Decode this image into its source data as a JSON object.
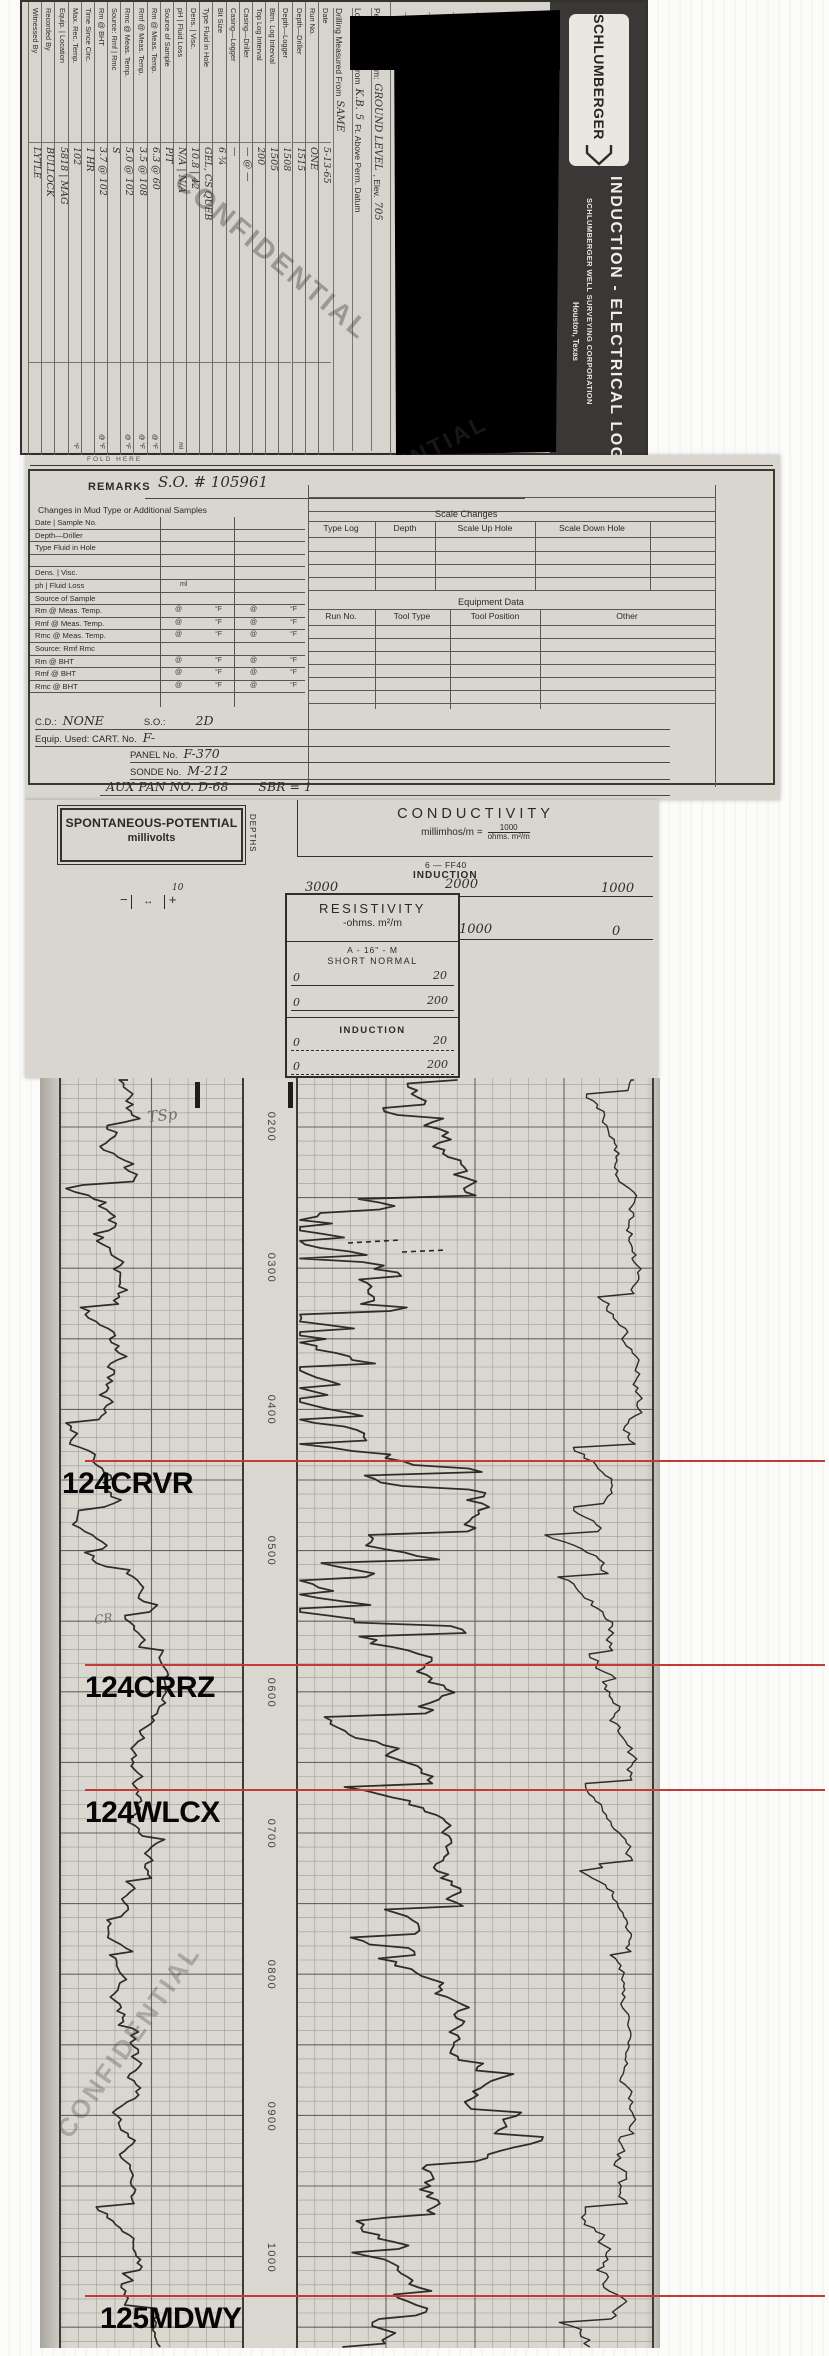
{
  "banner": {
    "logo": "SCHLUMBERGER",
    "title": "INDUCTION - ELECTRICAL LOG",
    "subtitle": "SCHLUMBERGER WELL SURVEYING CORPORATION",
    "city": "Houston, Texas"
  },
  "stamps": {
    "confidential": "CONFIDENTIAL",
    "fold": "FOLD HERE"
  },
  "datum": {
    "l1a": "Permanent Datum:",
    "l1v": "GROUND LEVEL",
    "l1b": ", Elev.",
    "l1v2": "705",
    "l2a": "Log Measured From",
    "l2v": "K.B.",
    "l2v2": "5",
    "l2b": "Ft. Above Perm. Datum",
    "l3a": "Drilling Measured From",
    "l3v": "SAME"
  },
  "run_table": {
    "rows": [
      {
        "label": "Date",
        "value": "5-13-65",
        "unit": ""
      },
      {
        "label": "Run No.",
        "value": "ONE",
        "unit": ""
      },
      {
        "label": "Depth—Driller",
        "value": "1515",
        "unit": ""
      },
      {
        "label": "Depth—Logger",
        "value": "1508",
        "unit": ""
      },
      {
        "label": "Btm. Log Interval",
        "value": "1505",
        "unit": ""
      },
      {
        "label": "Top Log Interval",
        "value": "200",
        "unit": ""
      },
      {
        "label": "Casing—Driller",
        "value": "— @ —",
        "unit": ""
      },
      {
        "label": "Casing—Logger",
        "value": "—",
        "unit": ""
      },
      {
        "label": "Bit Size",
        "value": "6 ¾",
        "unit": ""
      },
      {
        "label": "Type Fluid in Hole",
        "value": "GEL, CS   QUEB",
        "unit": ""
      },
      {
        "label": "Dens.  |  Visc.",
        "value": "10.8  |  42",
        "unit": ""
      },
      {
        "label": "pH  |  Fluid Loss",
        "value": "N/A  |  N/A",
        "unit": "ml"
      },
      {
        "label": "Source of Sample",
        "value": "PIT",
        "unit": ""
      },
      {
        "label": "Rm @ Meas. Temp.",
        "value": "6.3 @ 60",
        "unit": "@      °F"
      },
      {
        "label": "Rmf @ Meas. Temp.",
        "value": "3.5 @ 108",
        "unit": "@      °F"
      },
      {
        "label": "Rmc @ Meas. Temp.",
        "value": "5.0 @ 102",
        "unit": "@      °F"
      },
      {
        "label": "Source: Rmf  |  Rmc",
        "value": "S",
        "unit": ""
      },
      {
        "label": "Rm @ BHT",
        "value": "3.7 @ 102",
        "unit": "@      °F"
      },
      {
        "label": "Time Since Circ.",
        "value": "1 HR",
        "unit": ""
      },
      {
        "label": "Max. Rec. Temp.",
        "value": "102",
        "unit": "°F"
      },
      {
        "label": "Equip.  |  Location",
        "value": "5818  |  MAG",
        "unit": ""
      },
      {
        "label": "Recorded By",
        "value": "BULLOCK",
        "unit": ""
      },
      {
        "label": "Witnessed By",
        "value": "LYTLE",
        "unit": ""
      }
    ]
  },
  "remarks": {
    "label": "REMARKS",
    "value": "S.O. # 105961",
    "changes_title": "Changes in Mud Type or Additional Samples",
    "rows": [
      {
        "text": "Date  |  Sample No.",
        "temp": false,
        "unit": ""
      },
      {
        "text": "Depth—Driller",
        "temp": false,
        "unit": ""
      },
      {
        "text": "Type Fluid in Hole",
        "temp": false,
        "unit": ""
      },
      {
        "text": "",
        "temp": false,
        "unit": ""
      },
      {
        "text": "Dens.  |  Visc.",
        "temp": false,
        "unit": ""
      },
      {
        "text": "ph  |  Fluid Loss",
        "temp": false,
        "unit": "ml"
      },
      {
        "text": "Source of Sample",
        "temp": false,
        "unit": ""
      },
      {
        "text": "Rm @ Meas. Temp.",
        "temp": true,
        "unit": ""
      },
      {
        "text": "Rmf @ Meas. Temp.",
        "temp": true,
        "unit": ""
      },
      {
        "text": "Rmc @ Meas. Temp.",
        "temp": true,
        "unit": ""
      },
      {
        "text": "Source: Rmf      Rmc",
        "temp": false,
        "unit": ""
      },
      {
        "text": "Rm @ BHT",
        "temp": true,
        "unit": ""
      },
      {
        "text": "Rmf @ BHT",
        "temp": true,
        "unit": ""
      },
      {
        "text": "Rmc @ BHT",
        "temp": true,
        "unit": ""
      }
    ],
    "scale_changes": {
      "title": "Scale Changes",
      "columns": [
        "Type Log",
        "Depth",
        "Scale Up Hole",
        "Scale Down Hole"
      ]
    },
    "equipment": {
      "title": "Equipment Data",
      "columns": [
        "Run No.",
        "Tool Type",
        "Tool Position",
        "Other"
      ]
    },
    "footer": [
      {
        "pre": "C.D.:",
        "hw": "NONE",
        "pre2": "S.O.:",
        "hw2": "2D",
        "indent": 5
      },
      {
        "pre": "Equip. Used:  CART. No.",
        "hw": "F-",
        "pre2": "",
        "hw2": "",
        "indent": 5
      },
      {
        "pre": "PANEL No.",
        "hw": "F-370",
        "pre2": "",
        "hw2": "",
        "indent": 100
      },
      {
        "pre": "SONDE No.",
        "hw": "M-212",
        "pre2": "",
        "hw2": "",
        "indent": 100
      },
      {
        "pre": "",
        "hw": "AUX PAN NO. D-68",
        "pre2": "",
        "hw2": "SBR = 1",
        "indent": 70
      }
    ]
  },
  "scale_header": {
    "sp_title": "SPONTANEOUS-POTENTIAL",
    "sp_units": "millivolts",
    "sp_minus": "−",
    "sp_scale": "10",
    "sp_plus": "+",
    "depths": "DEPTHS",
    "cond_title": "CONDUCTIVITY",
    "cond_units": "millimhos/m =",
    "cond_frac_top": "1000",
    "cond_frac_bot": "ohms. m²/m",
    "tool_line": "6 — FF40",
    "tool_line2": "INDUCTION",
    "cond_scale1": {
      "left": "3000",
      "mid": "2000",
      "right": "1000"
    },
    "cond_scale2": {
      "mid": "1000",
      "right": "0"
    },
    "res_title": "RESISTIVITY",
    "res_units": "-ohms. m²/m",
    "sn1": "A - 16\" - M",
    "sn2": "SHORT NORMAL",
    "sn_scales": [
      {
        "l": "0",
        "r": "20"
      },
      {
        "l": "0",
        "r": "200"
      }
    ],
    "ind_label": "INDUCTION",
    "ind_scales": [
      {
        "l": "0",
        "r": "20"
      },
      {
        "l": "0",
        "r": "200"
      }
    ]
  },
  "log": {
    "depth_labels": [
      {
        "t": "0200",
        "y": 1127
      },
      {
        "t": "0300",
        "y": 1268
      },
      {
        "t": "0400",
        "y": 1410
      },
      {
        "t": "0500",
        "y": 1551
      },
      {
        "t": "0600",
        "y": 1693
      },
      {
        "t": "0700",
        "y": 1834
      },
      {
        "t": "0800",
        "y": 1975
      },
      {
        "t": "0900",
        "y": 2117
      },
      {
        "t": "1000",
        "y": 2258
      }
    ],
    "markers": [
      {
        "label": "124CRVR",
        "y": 1461,
        "x": 62
      },
      {
        "label": "124CRRZ",
        "y": 1665,
        "x": 85
      },
      {
        "label": "124WLCX",
        "y": 1790,
        "x": 85
      },
      {
        "label": "125MDWY",
        "y": 2296,
        "x": 100
      }
    ],
    "marker_color": "#c23b36",
    "pencil": [
      {
        "t": "TSp",
        "x": 148,
        "y": 1122,
        "r": -6,
        "s": 15
      },
      {
        "t": "CR",
        "x": 95,
        "y": 1624,
        "r": -8,
        "s": 12
      }
    ],
    "curves": [
      {
        "name": "sp-curve",
        "seed": 7,
        "min": 66,
        "max": 238,
        "width": 1.7,
        "pspike": 0.04,
        "pamp": 22,
        "segments": [
          {
            "to": 1180,
            "base": 128,
            "vol": 9,
            "spike": 0.05,
            "spikeAmp": -35
          },
          {
            "to": 1330,
            "base": 108,
            "vol": 11,
            "spike": 0.08,
            "spikeAmp": -30
          },
          {
            "to": 1460,
            "base": 122,
            "vol": 9,
            "spike": 0.05,
            "spikeAmp": -30
          },
          {
            "to": 1560,
            "base": 112,
            "vol": 10,
            "spike": 0.06,
            "spikeAmp": -25
          },
          {
            "to": 1700,
            "base": 148,
            "vol": 5,
            "spike": 0.03,
            "spikeAmp": -20
          },
          {
            "to": 1950,
            "base": 138,
            "vol": 6,
            "spike": 0.04,
            "spikeAmp": -22
          },
          {
            "to": 2160,
            "base": 126,
            "vol": 7,
            "spike": 0.04,
            "spikeAmp": -18
          },
          {
            "to": 2360,
            "base": 140,
            "vol": 5,
            "spike": 0.05,
            "spikeAmp": -28
          }
        ]
      },
      {
        "name": "conductivity-curve",
        "seed": 13,
        "min": 300,
        "max": 648,
        "width": 1.8,
        "pspike": 0.05,
        "pamp": 55,
        "segments": [
          {
            "to": 1190,
            "base": 455,
            "vol": 14,
            "spike": 0.1,
            "spikeAmp": -90
          },
          {
            "to": 1340,
            "base": 430,
            "vol": 20,
            "spike": 0.16,
            "spikeAmp": -110
          },
          {
            "to": 1480,
            "base": 455,
            "vol": 16,
            "spike": 0.12,
            "spikeAmp": -120
          },
          {
            "to": 1650,
            "base": 470,
            "vol": 18,
            "spike": 0.14,
            "spikeAmp": -140
          },
          {
            "to": 1790,
            "base": 455,
            "vol": 14,
            "spike": 0.1,
            "spikeAmp": -90
          },
          {
            "to": 2000,
            "base": 470,
            "vol": 10,
            "spike": 0.06,
            "spikeAmp": -60
          },
          {
            "to": 2170,
            "base": 450,
            "vol": 9,
            "spike": 0.05,
            "spikeAmp": -50
          },
          {
            "to": 2360,
            "base": 430,
            "vol": 12,
            "spike": 0.08,
            "spikeAmp": -60
          }
        ]
      },
      {
        "name": "edge-curve",
        "seed": 29,
        "min": 545,
        "max": 650,
        "width": 1.4,
        "pspike": 0,
        "pamp": 0,
        "segments": [
          {
            "to": 1400,
            "base": 634,
            "vol": 5,
            "spike": 0.06,
            "spikeAmp": -40
          },
          {
            "to": 1800,
            "base": 628,
            "vol": 6,
            "spike": 0.08,
            "spikeAmp": -45
          },
          {
            "to": 2150,
            "base": 636,
            "vol": 4,
            "spike": 0.05,
            "spikeAmp": -35
          },
          {
            "to": 2360,
            "base": 612,
            "vol": 8,
            "spike": 0.1,
            "spikeAmp": -45
          }
        ]
      }
    ]
  }
}
